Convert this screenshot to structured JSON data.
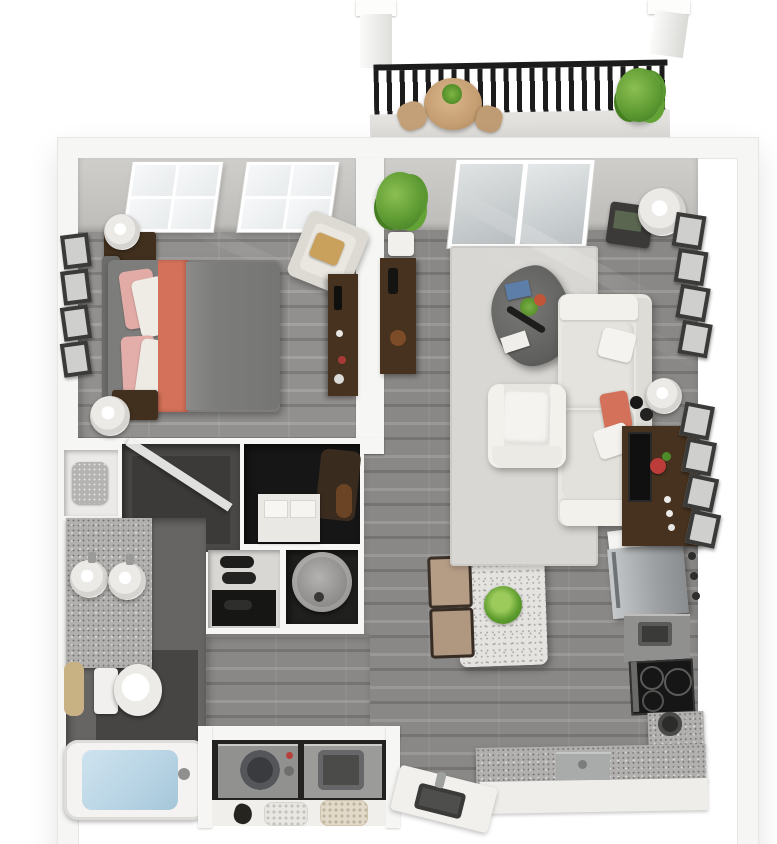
{
  "scene": {
    "kind": "3d-floorplan-render",
    "description": "Top-down dollhouse view of a one-bedroom, one-bath apartment with balcony",
    "visible_text": "",
    "rooms": [
      {
        "id": "balcony",
        "contents": [
          "black-metal-railing",
          "white-corner-posts",
          "round-wicker-patio-table",
          "patio-chairs",
          "potted-plant"
        ]
      },
      {
        "id": "bedroom",
        "contents": [
          "double-window",
          "bed-gray-duvet-coral-throw",
          "pink-and-white-pillows",
          "gray-headboard",
          "corner-table-with-white-jug",
          "nightstand-with-lamp",
          "wall-picture-frames",
          "cream-accent-chair-with-tan-pillow",
          "dark-wood-dresser"
        ]
      },
      {
        "id": "living-room",
        "contents": [
          "sliding-glass-door",
          "potted-floor-plant",
          "dark-console-table",
          "light-gray-area-rug",
          "pebble-coffee-table-with-flowers-and-books",
          "cream-sofa-with-coral-pillow",
          "white-armchair",
          "side-table-with-lamp",
          "table-lamp",
          "media-console-with-tv-and-red-flower",
          "two-columns-of-picture-frames"
        ]
      },
      {
        "id": "bathroom",
        "contents": [
          "granite-double-vanity",
          "two-round-sinks",
          "toilet",
          "tan-bath-mat",
          "bathtub-with-water",
          "dark-tile-floor"
        ]
      },
      {
        "id": "shower-room",
        "contents": [
          "dark-tiled-shower",
          "glass-panel"
        ]
      },
      {
        "id": "linen-closet",
        "contents": [
          "folded-towel"
        ]
      },
      {
        "id": "walk-in-closet",
        "contents": [
          "hanging-clothes",
          "white-dresser",
          "storage-boxes"
        ]
      },
      {
        "id": "shoe-closet",
        "contents": [
          "shoe-shelves",
          "black-shoes"
        ]
      },
      {
        "id": "utility-closet",
        "contents": [
          "water-heater"
        ]
      },
      {
        "id": "laundry-closet",
        "contents": [
          "front-load-washer",
          "front-load-dryer",
          "shelf-with-baskets"
        ]
      },
      {
        "id": "kitchen",
        "contents": [
          "white-pass-shelf",
          "stainless-refrigerator",
          "oven-cabinet",
          "black-cooktop",
          "l-shaped-granite-counter",
          "dishwasher",
          "angled-sink-counter-with-faucet",
          "corner-pot"
        ]
      },
      {
        "id": "dining-area",
        "contents": [
          "speckled-white-table",
          "green-centerpiece",
          "two-tan-chairs"
        ]
      },
      {
        "id": "hallway",
        "contents": [
          "gray-plank-flooring"
        ]
      }
    ]
  },
  "palette": {
    "page_bg": "#ffffff",
    "wall": "#f6f6f4",
    "wall_edge": "#e6e6e3",
    "wood_base": "#8a8886",
    "wood_dark": "#767472",
    "wood_light": "#9a9896",
    "rug": "#d8d7d3",
    "sofa": "#e9e7e1",
    "cushion": "#f2f1ec",
    "coral": "#d4715a",
    "pink": "#e2aba6",
    "duvet": "#7d7d7b",
    "headboard": "#6c6c6a",
    "dark_wood": "#46321f",
    "granite": "#b2b0ae",
    "dining_top": "#e4e3e0",
    "steel": "#a7aaac",
    "cooktop": "#161616",
    "tile": "#676563",
    "tile_dark": "#474543",
    "closet_dark": "#161616",
    "water": "#b9d5e5",
    "plant": "#5f9c33",
    "plant_dark": "#3e7a22",
    "railing": "#1c1c1c",
    "patio_tan": "#c59e72",
    "mat_tan": "#c8b183",
    "red_accent": "#b8403c",
    "machine": "#919190",
    "glass": "#cdd2d4"
  }
}
